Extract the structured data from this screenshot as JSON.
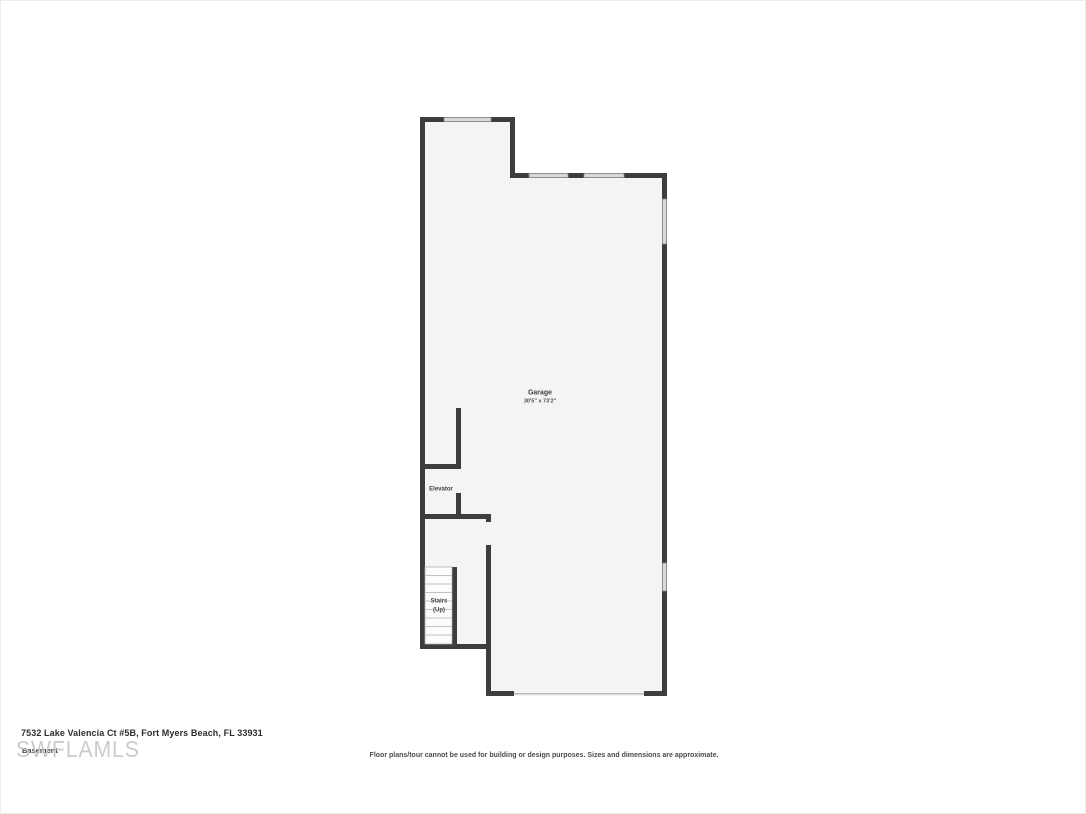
{
  "floor_plan": {
    "labels": {
      "garage_name": "Garage",
      "garage_dims": "30'5\" x 73'2\"",
      "elevator": "Elevator",
      "stairs_line1": "Stairs",
      "stairs_line2": "(Up)"
    },
    "features": [
      "window-top-left",
      "window-top-mid-1",
      "window-top-mid-2",
      "window-right-upper",
      "window-right-lower",
      "garage-door-opening",
      "elevator-door-opening",
      "stairs-door-opening",
      "stair-treads"
    ]
  },
  "footer": {
    "address": "7532 Lake Valencia Ct #5B, Fort Myers Beach, FL 33931",
    "floor_label": "Basement",
    "watermark": "SWFLAMLS",
    "disclaimer": "Floor plans/tour cannot be used for building or design purposes. Sizes and dimensions are approximate."
  },
  "colors": {
    "wall": "#3d3d3d",
    "floor_fill": "#f4f4f4",
    "window_fill": "#d8d8d8",
    "window_stroke": "#8f8f8f",
    "tread_line": "#c2c2c2",
    "watermark": "#c3c3c3",
    "background": "#ffffff"
  }
}
